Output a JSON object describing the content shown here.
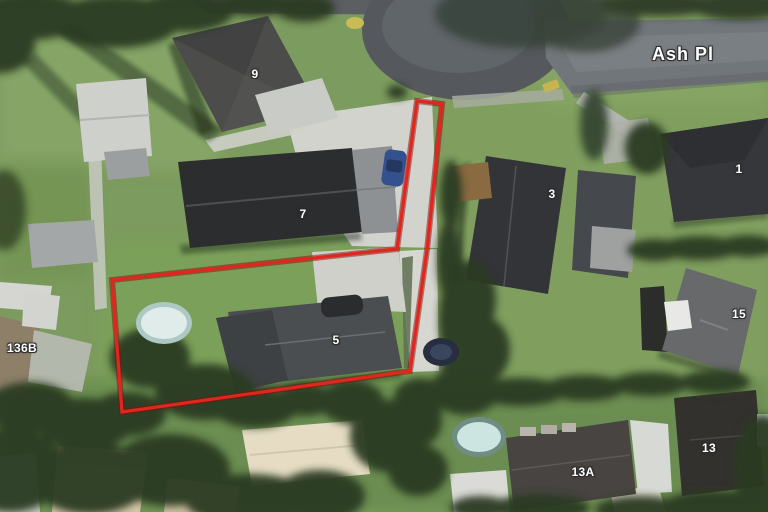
{
  "map": {
    "street_name": "Ash Pl",
    "highlighted_parcel": "5",
    "labels": {
      "p9": "9",
      "p7": "7",
      "p5": "5",
      "p3": "3",
      "p1": "1",
      "p15": "15",
      "p13a": "13A",
      "p13": "13",
      "p136b": "136B"
    },
    "colors": {
      "boundary": "#e2261d",
      "boundary_halo": "#7e120d",
      "grass": "#7c9b5e",
      "road": "#55585c",
      "concrete": "#d2d3cc"
    }
  }
}
